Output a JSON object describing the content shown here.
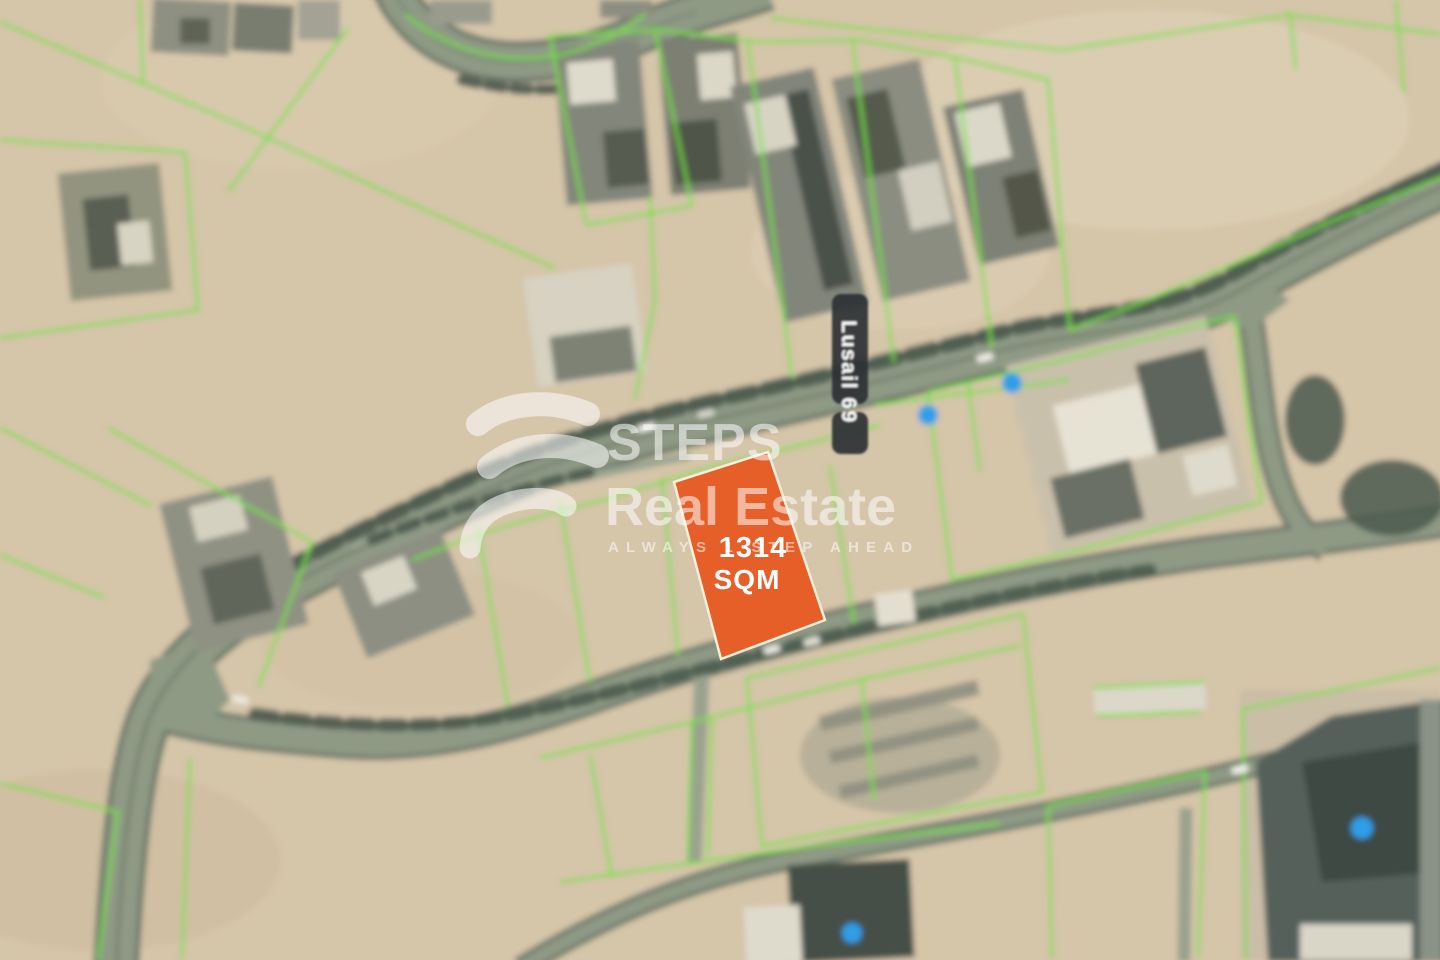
{
  "map": {
    "street_label": "Lusail 69",
    "plot_label": {
      "line1": "1314",
      "line2": "SQM"
    },
    "colors": {
      "plot_orange": "#E65E28",
      "plot_border": "#F7EEDC",
      "parcel_green": "#74DE3B",
      "marker_blue": "#2F9FE8",
      "sand": "#d5c5a9",
      "road_fill": "#8f9a85",
      "road_casing": "#6b7767",
      "tree_dark": "#4b5a4e",
      "label_pill": "#2a2f33"
    }
  },
  "watermark": {
    "brand_top": "STEPS",
    "brand_bottom": "Real Estate",
    "tagline": "ALWAYS 1 STEP AHEAD"
  }
}
